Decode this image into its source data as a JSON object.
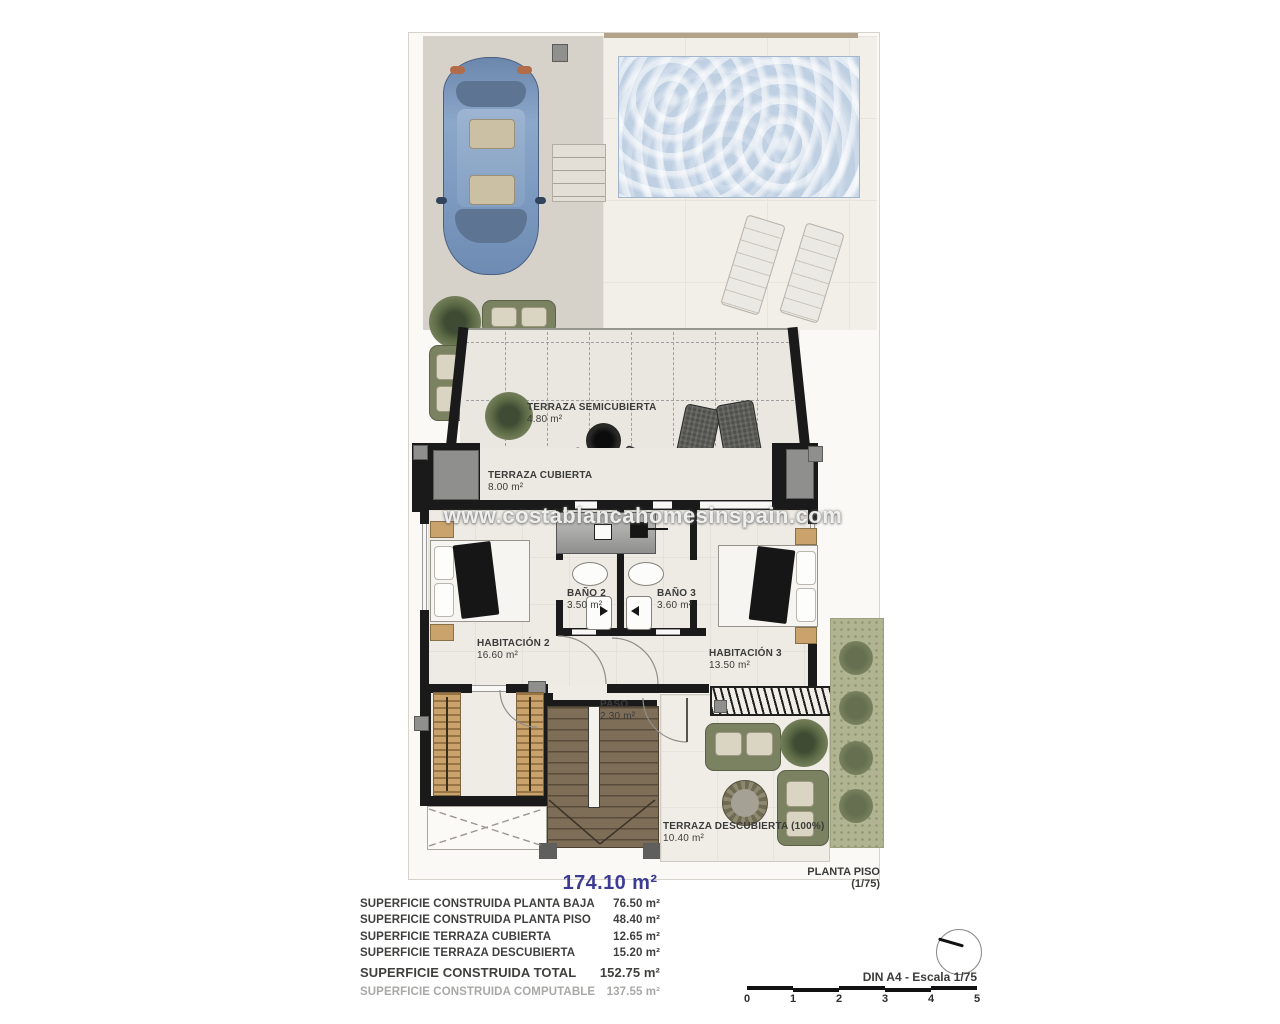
{
  "watermark": "www.costablancahomesinspain.com",
  "plan": {
    "name_label": "PLANTA PISO (1/75)",
    "total_area": "174.10 m²"
  },
  "rooms": [
    {
      "name": "TERRAZA SEMICUBIERTA",
      "area": "4.80 m²"
    },
    {
      "name": "TERRAZA CUBIERTA",
      "area": "8.00 m²"
    },
    {
      "name": "BAÑO 2",
      "area": "3.50 m²"
    },
    {
      "name": "BAÑO 3",
      "area": "3.60 m²"
    },
    {
      "name": "HABITACIÓN 2",
      "area": "16.60 m²"
    },
    {
      "name": "HABITACIÓN 3",
      "area": "13.50 m²"
    },
    {
      "name": "PASO",
      "area": "2.30 m²"
    },
    {
      "name": "TERRAZA DESCUBIERTA (100%)",
      "area": "10.40 m²"
    }
  ],
  "summary": {
    "rows": [
      {
        "label": "SUPERFICIE CONSTRUIDA PLANTA BAJA",
        "value": "76.50 m²"
      },
      {
        "label": "SUPERFICIE CONSTRUIDA PLANTA PISO",
        "value": "48.40 m²"
      },
      {
        "label": "SUPERFICIE TERRAZA CUBIERTA",
        "value": "12.65 m²"
      },
      {
        "label": "SUPERFICIE TERRAZA DESCUBIERTA",
        "value": "15.20 m²"
      }
    ],
    "total": {
      "label": "SUPERFICIE CONSTRUIDA TOTAL",
      "value": "152.75 m²"
    },
    "computable": {
      "label": "SUPERFICIE CONSTRUIDA COMPUTABLE",
      "value": "137.55 m²"
    }
  },
  "scale": {
    "label": "DIN A4 - Escala 1/75",
    "ticks": [
      "0",
      "1",
      "2",
      "3",
      "4",
      "5"
    ]
  },
  "colors": {
    "accent_blue": "#3c3c92",
    "wall_black": "#1a1a1a",
    "pool_blue": "#c9d7e7",
    "garden_green": "#b0b491",
    "olive_furniture": "#7b8261",
    "wood_tan": "#c9a36b",
    "driveway_beige": "#d7d2c9",
    "floor_offwhite": "#edebe4",
    "muted_text": "#a8a8a6"
  }
}
